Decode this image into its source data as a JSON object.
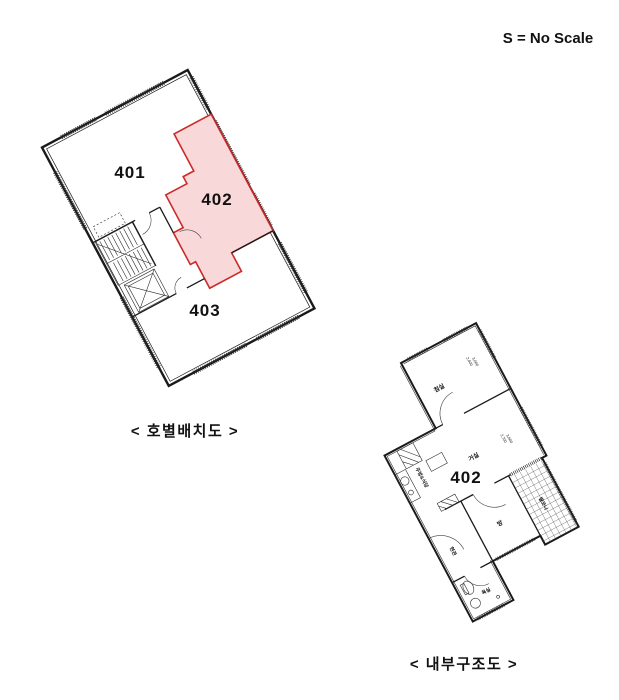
{
  "scale_note": {
    "text": "S = No Scale"
  },
  "colors": {
    "blue": "#1414cc",
    "red": "#cc1a1a",
    "pink": "#f8d8d8",
    "line": "#1a1a1a"
  },
  "unit_layout_diagram": {
    "caption": "< 호별배치도 >",
    "units": [
      {
        "id": "401",
        "label": "401",
        "highlighted": false
      },
      {
        "id": "402",
        "label": "402",
        "highlighted": true
      },
      {
        "id": "403",
        "label": "403",
        "highlighted": false
      }
    ]
  },
  "internal_structure_diagram": {
    "caption": "< 내부구조도 >",
    "unit_label": "402",
    "room_labels": {
      "bedroom": "침실",
      "living": "거실",
      "kitchen_dining": "주방&식당",
      "entrance": "현관",
      "room": "방",
      "bathroom": "욕실",
      "balcony": "발코니"
    },
    "dimension_labels": {
      "bedroom_w": "2,400",
      "bedroom_d": "3,000",
      "living_w": "2,700",
      "living_d": "3,600"
    }
  }
}
